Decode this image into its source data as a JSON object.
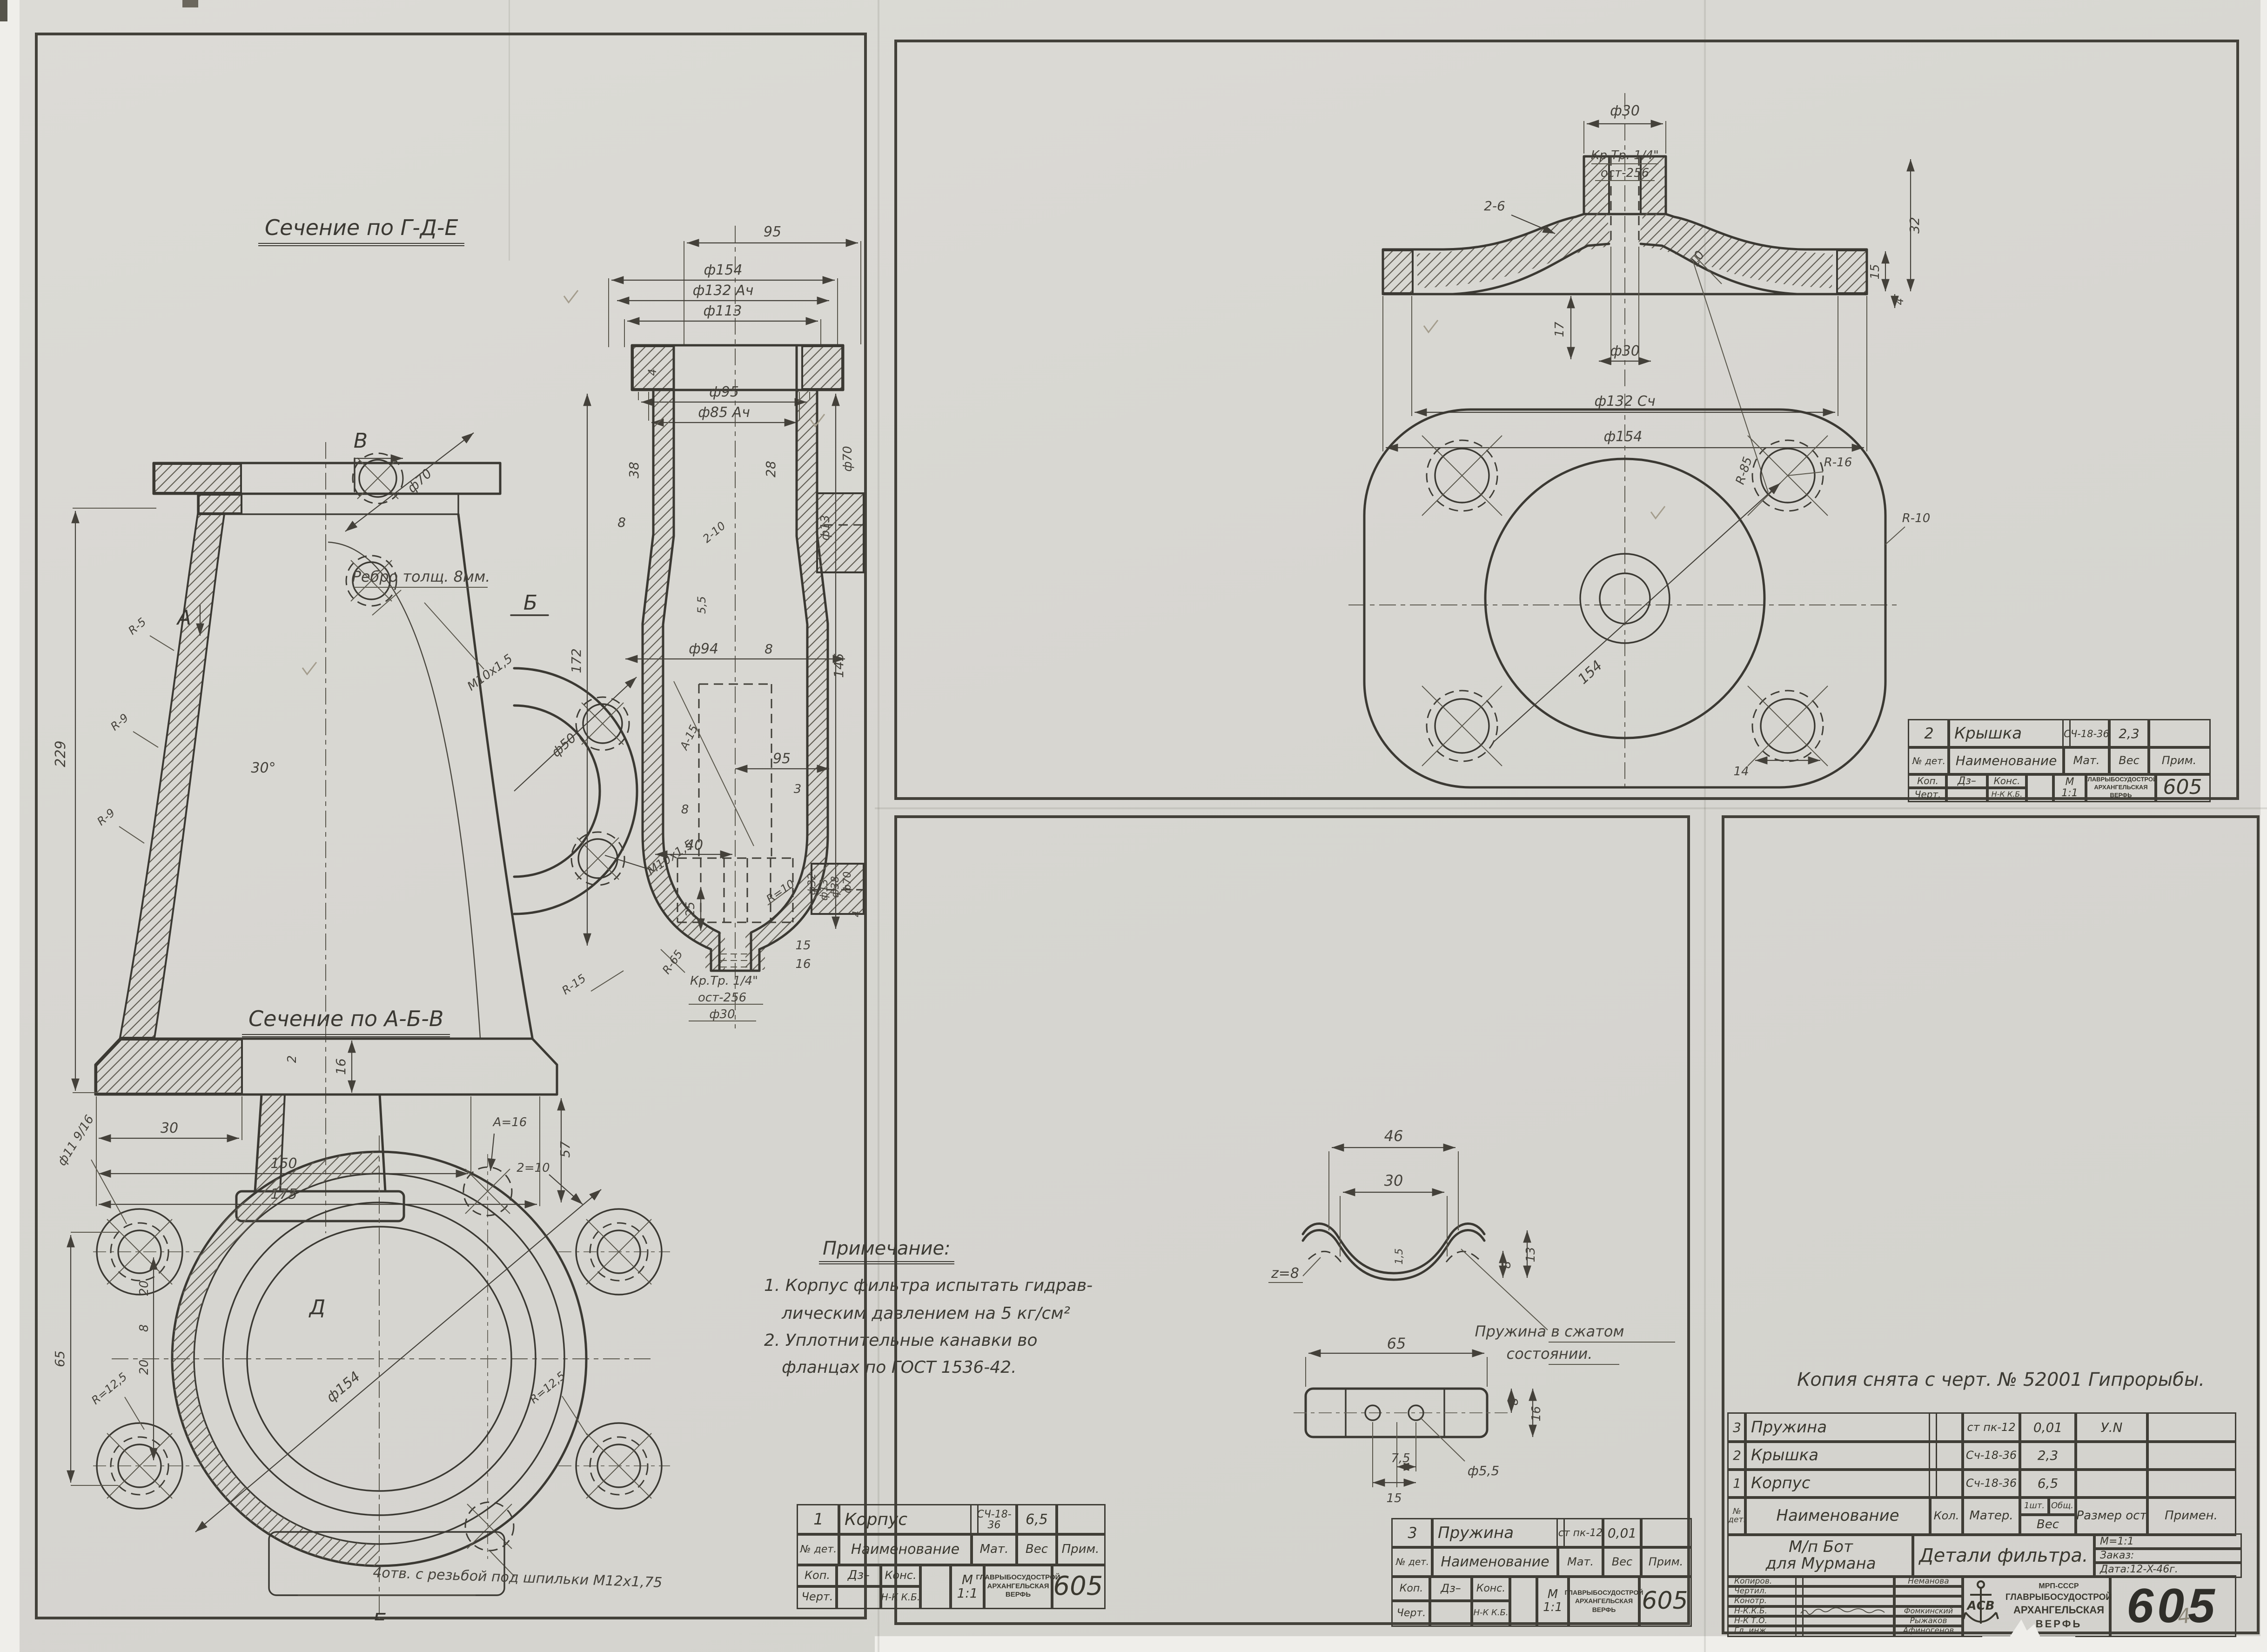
{
  "body": {
    "sec1_title": "Сечение по Г-Д-Е",
    "sec2_title": "Сечение по А-Б-В",
    "rib_note": "Ребро толщ. 8мм.",
    "stud_note": "4отв. с резьбой под шпильки М12х1,75",
    "notes": {
      "title": "Примечание:",
      "l1": "1. Корпус фильтра испытать гидрав-",
      "l2": "лическим давлением на 5 кг/см²",
      "l3": "2. Уплотнительные канавки во",
      "l4": "фланцах по ГОСТ 1536-42."
    },
    "thread": {
      "l1": "Кр.Тр. 1/4\"",
      "l2": "ост-256",
      "l3": "ф30"
    },
    "markers": {
      "a": "А",
      "b": "Б",
      "v": "В",
      "d": "Д",
      "e": "Е"
    },
    "dims": {
      "d229": "229",
      "ang30": "30°",
      "f50": "ф50",
      "m10a": "М10х1,5",
      "f70a": "ф70",
      "m10b": "М10х1,5",
      "r5": "R-5",
      "r9a": "R-9",
      "r9b": "R-9",
      "t16": "16",
      "t2": "2",
      "t30": "30",
      "t150": "150",
      "t175": "175",
      "t57": "57",
      "v95a": "95",
      "f154": "ф154",
      "f132": "ф132 Ач",
      "f113": "ф113",
      "f95": "ф95",
      "f85": "ф85 Ач",
      "t4a": "4",
      "t38": "38",
      "t28": "28",
      "t8a": "8",
      "f70b": "ф70",
      "f13a": "ф13",
      "t2_10": "2-10",
      "t55": "5,5",
      "t172": "172",
      "f94": "ф94",
      "t8b": "8",
      "v95b": "95",
      "t3": "3",
      "t8c": "8",
      "t40": "40",
      "t25": "25",
      "r10": "R=10",
      "r65": "R-65",
      "r15": "R-15",
      "a15": "А-15",
      "t145": "145",
      "f32": "ф32",
      "f13b": "ф13",
      "f38": "ф38",
      "f70c": "ф70",
      "t4b": "4",
      "t15a": "15",
      "t16a": "16",
      "f11": "ф11 9/16",
      "t65": "65",
      "t20a": "20",
      "t8d": "8",
      "t20b": "20",
      "r125a": "R=12,5",
      "r125b": "R=12,5",
      "f154b": "ф154",
      "a16": "А=16",
      "z10": "2=10"
    },
    "tb": {
      "num": "1",
      "name": "Корпус",
      "mat": "СЧ-18-36",
      "ves": "6,5",
      "prim": "",
      "h_num": "№ дет.",
      "h_name": "Наименование",
      "h_mat": "Мат.",
      "h_ves": "Вес",
      "h_prim": "Прим.",
      "kop": "Коп.",
      "kop_v": "Дз–",
      "kons": "Конс.",
      "chert": "Черт.",
      "nk": "Н-К К.Б.",
      "m": "М",
      "scale": "1:1",
      "org1": "ГЛАВРЫБОСУДОСТРОЙ",
      "org2": "АРХАНГЕЛЬСКАЯ",
      "org3": "ВЕРФЬ",
      "code": "605"
    }
  },
  "cover": {
    "dims": {
      "f30a": "ф30",
      "thr1": "Кр.Тр. 1/4\"",
      "thr2": "ост-256",
      "c26": "2-6",
      "f30b": "ф30",
      "t17": "17",
      "t32": "32",
      "t15": "15",
      "t4": "4",
      "t10": "10",
      "f132": "ф132 Сч",
      "f154": "ф154",
      "r85": "R-85",
      "d154": "154",
      "r16": "R-16",
      "r10": "R-10",
      "t14": "14"
    },
    "tb": {
      "num": "2",
      "name": "Крышка",
      "mat": "СЧ-18-36",
      "ves": "2,3",
      "prim": "",
      "h_num": "№ дет.",
      "h_name": "Наименование",
      "h_mat": "Мат.",
      "h_ves": "Вес",
      "h_prim": "Прим.",
      "kop": "Коп.",
      "kop_v": "Дз–",
      "kons": "Конс.",
      "chert": "Черт.",
      "nk": "Н-К К.Б.",
      "m": "М",
      "scale": "1:1",
      "org1": "ГЛАВРЫБОСУДОСТРОЙ",
      "org2": "АРХАНГЕЛЬСКАЯ",
      "org3": "ВЕРФЬ",
      "code": "605"
    }
  },
  "spring": {
    "note1": "Пружина в сжатом",
    "note2": "состоянии.",
    "dims": {
      "t46": "46",
      "t30": "30",
      "t15": "1,5",
      "t13": "13",
      "t8": "8",
      "z8": "z=8",
      "t65": "65",
      "t8b": "8",
      "t16": "16",
      "t75": "7,5",
      "t15b": "15",
      "f55": "ф5,5"
    },
    "tb": {
      "num": "3",
      "name": "Пружина",
      "mat": "ст пк-12",
      "ves": "0,01",
      "prim": "",
      "h_num": "№ дет.",
      "h_name": "Наименование",
      "h_mat": "Мат.",
      "h_ves": "Вес",
      "h_prim": "Прим.",
      "kop": "Коп.",
      "kop_v": "Дз–",
      "kons": "Конс.",
      "chert": "Черт.",
      "nk": "Н-К К.Б.",
      "m": "М",
      "scale": "1:1",
      "org1": "ГЛАВРЫБОСУДОСТРОЙ",
      "org2": "АРХАНГЕЛЬСКАЯ",
      "org3": "ВЕРФЬ",
      "code": "605"
    }
  },
  "main": {
    "copy_note": "Копия снята с черт. № 52001 Гипрорыбы.",
    "parts": [
      {
        "num": "3",
        "name": "Пружина",
        "qty": "",
        "mat": "ст пк-12",
        "w1": "0,01",
        "size": "У.N",
        "prim": ""
      },
      {
        "num": "2",
        "name": "Крышка",
        "qty": "",
        "mat": "Сч-18-36",
        "w1": "2,3",
        "size": "",
        "prim": ""
      },
      {
        "num": "1",
        "name": "Корпус",
        "qty": "",
        "mat": "Сч-18-36",
        "w1": "6,5",
        "size": "",
        "prim": ""
      }
    ],
    "hdr": {
      "num": "№ дет.",
      "name": "Наименование",
      "qty": "Кол.",
      "mat": "Матер.",
      "w1": "1шт.",
      "w2": "Общ.",
      "ves": "Вес",
      "size": "Размер ост",
      "prim": "Примен."
    },
    "object1": "М/п Бот",
    "object2": "для Мурмана",
    "title": "Детали фильтра.",
    "scale": "М=1:1",
    "order": "Заказ:",
    "date": "Дата:12-X-46г.",
    "sign_rows": [
      {
        "label": "Копиров.",
        "name": "Неманова"
      },
      {
        "label": "Чертил.",
        "name": ""
      },
      {
        "label": "Конотр.",
        "name": ""
      },
      {
        "label": "Н-К.К.Б.",
        "name": "Фомкинский"
      },
      {
        "label": "Н-К Т.О.",
        "name": "Рыжаков"
      },
      {
        "label": "Гл. инж.",
        "name": "Афиногенов"
      }
    ],
    "emblem": [
      "МРП-СССР",
      "ГЛАВРЫБОСУДОСТРОЙ",
      "АРХАНГЕЛЬСКАЯ",
      "ВЕРФЬ"
    ],
    "monogram": "АСВ",
    "code": "605",
    "pencil": "4"
  }
}
